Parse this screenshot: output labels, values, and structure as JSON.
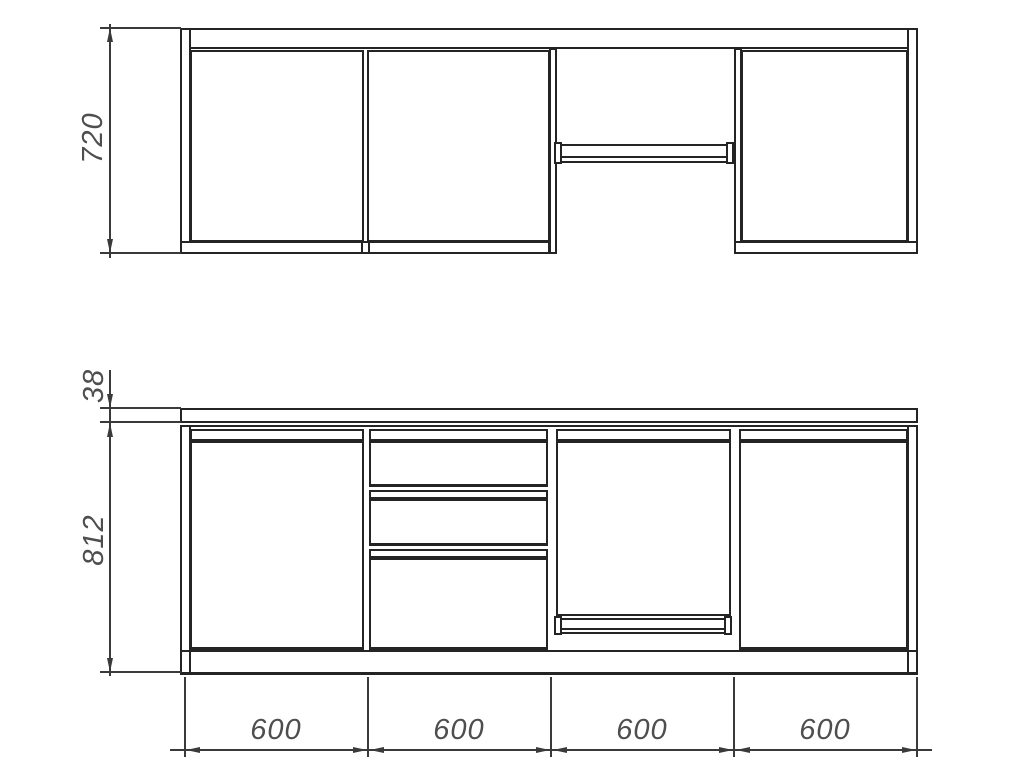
{
  "drawing": {
    "type": "kitchen-cabinet-elevation",
    "dimensions": {
      "upper_height": "720",
      "worktop_thickness": "38",
      "base_height": "812",
      "section_widths": [
        "600",
        "600",
        "600",
        "600"
      ]
    },
    "colors": {
      "line": "#242424",
      "dimension_line": "#3a3a3a",
      "text": "#4e4e4e",
      "background": "#ffffff"
    }
  }
}
